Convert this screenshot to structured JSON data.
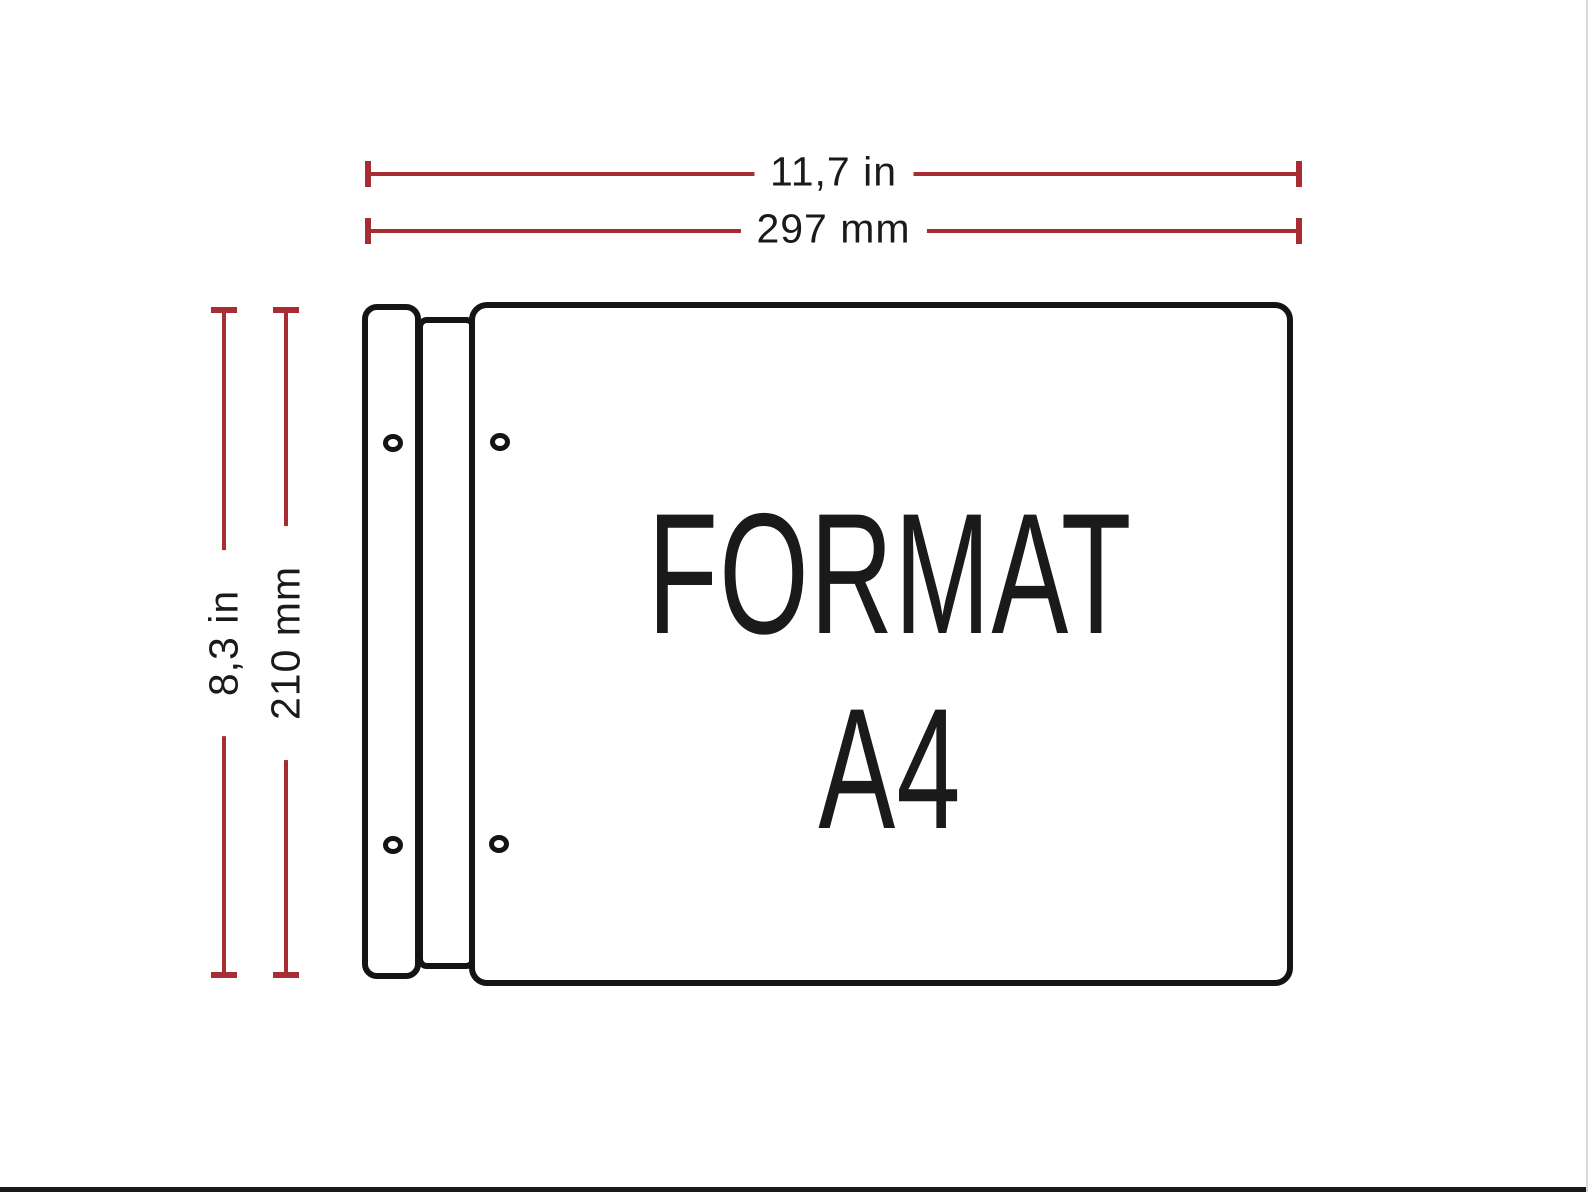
{
  "colors": {
    "background": "#ffffff",
    "dimension-red": "#a72d33",
    "outline-black": "#141414",
    "text-black": "#1a1a1a",
    "frame-line": "#1a1a1a",
    "right-edge-line": "#d9d9d9"
  },
  "dimensions": {
    "top_inches": "11,7 in",
    "top_millimeters": "297 mm",
    "left_inches": "8,3 in",
    "left_millimeters": "210 mm"
  },
  "sheet": {
    "format_word": "FORMAT",
    "format_code": "A4"
  }
}
